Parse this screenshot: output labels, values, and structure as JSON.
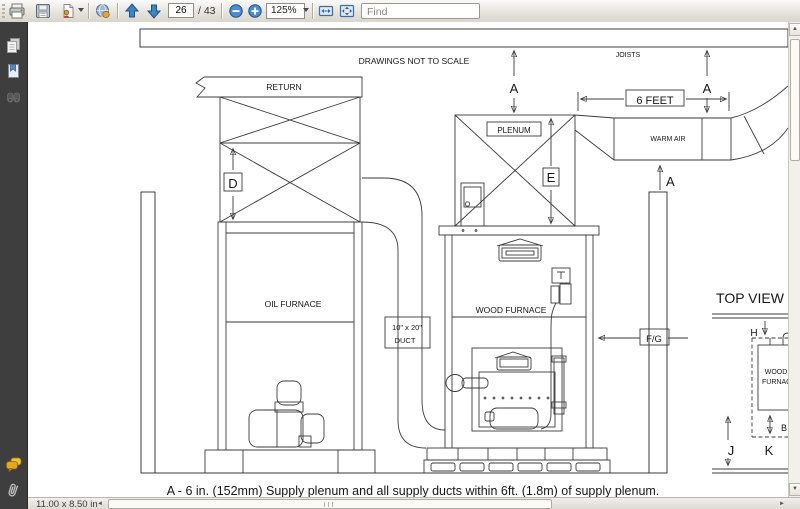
{
  "toolbar": {
    "page_current": "26",
    "page_total": "/ 43",
    "zoom_value": "125%",
    "find_placeholder": "Find"
  },
  "statusbar": {
    "document_size": "11.00 x 8.50 in"
  },
  "diagram": {
    "scale_note": "DRAWINGS NOT TO SCALE",
    "joists": "JOISTS",
    "return_duct": "RETURN",
    "plenum": "PLENUM",
    "warm_air": "WARM AIR",
    "six_feet": "6 FEET",
    "oil_furnace": "OIL FURNACE",
    "wood_furnace": "WOOD FURNACE",
    "duct_size_line1": "10\" x 20\"",
    "duct_size_line2": "DUCT",
    "dim_a": "A",
    "dim_d": "D",
    "dim_e": "E",
    "dim_fg": "F/G",
    "dim_h": "H",
    "dim_b": "B",
    "dim_j": "J",
    "dim_k": "K",
    "top_view": "TOP VIEW",
    "top_view_wood": "WOOD",
    "top_view_furnace": "FURNACE",
    "caption": "A - 6 in. (152mm) Supply plenum and all supply ducts within 6ft. (1.8m) of supply plenum."
  }
}
